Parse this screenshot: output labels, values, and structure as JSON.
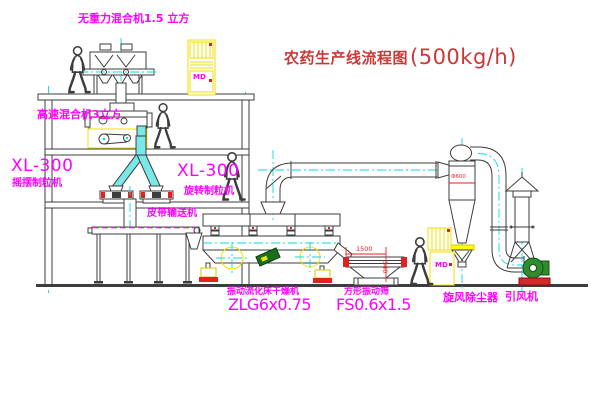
{
  "title": {
    "text": "农药生产线流程图",
    "capacity": "(500kg/h)"
  },
  "equipment_labels": {
    "gravity_free_mixer": "无重力混合机1.5 立方",
    "high_speed_mixer": "高速混合机3立方",
    "granulator_left": {
      "model": "XL-300",
      "name": "摇摆制粒机"
    },
    "granulator_right": {
      "model": "XL-300",
      "name": "旋转制粒机"
    },
    "belt_conveyor": "皮带输送机",
    "fluid_bed_dryer": {
      "name": "振动流化床干燥机",
      "model": "ZLG6x0.75"
    },
    "square_vibrating_screen": {
      "name": "方形振动筛",
      "model": "FS0.6x1.5"
    },
    "cyclone_dust_collector": "旋风除尘器",
    "induced_draft_fan": "引风机"
  },
  "annotations": {
    "screen_width_dim": "1500",
    "screen_height_dim": "540",
    "cyclone_diameter": "Φ600",
    "cabinet_marking": "MD"
  },
  "colors": {
    "title_red": "#cb3838",
    "label_magenta": "#ff00ff",
    "dimension_red": "#ee2222",
    "line_dark": "#3d3d3d",
    "accent_yellow": "#ffff00",
    "centerline_cyan": "#00dede",
    "machine_green": "#2e8b2e",
    "background": "#ffffff"
  }
}
